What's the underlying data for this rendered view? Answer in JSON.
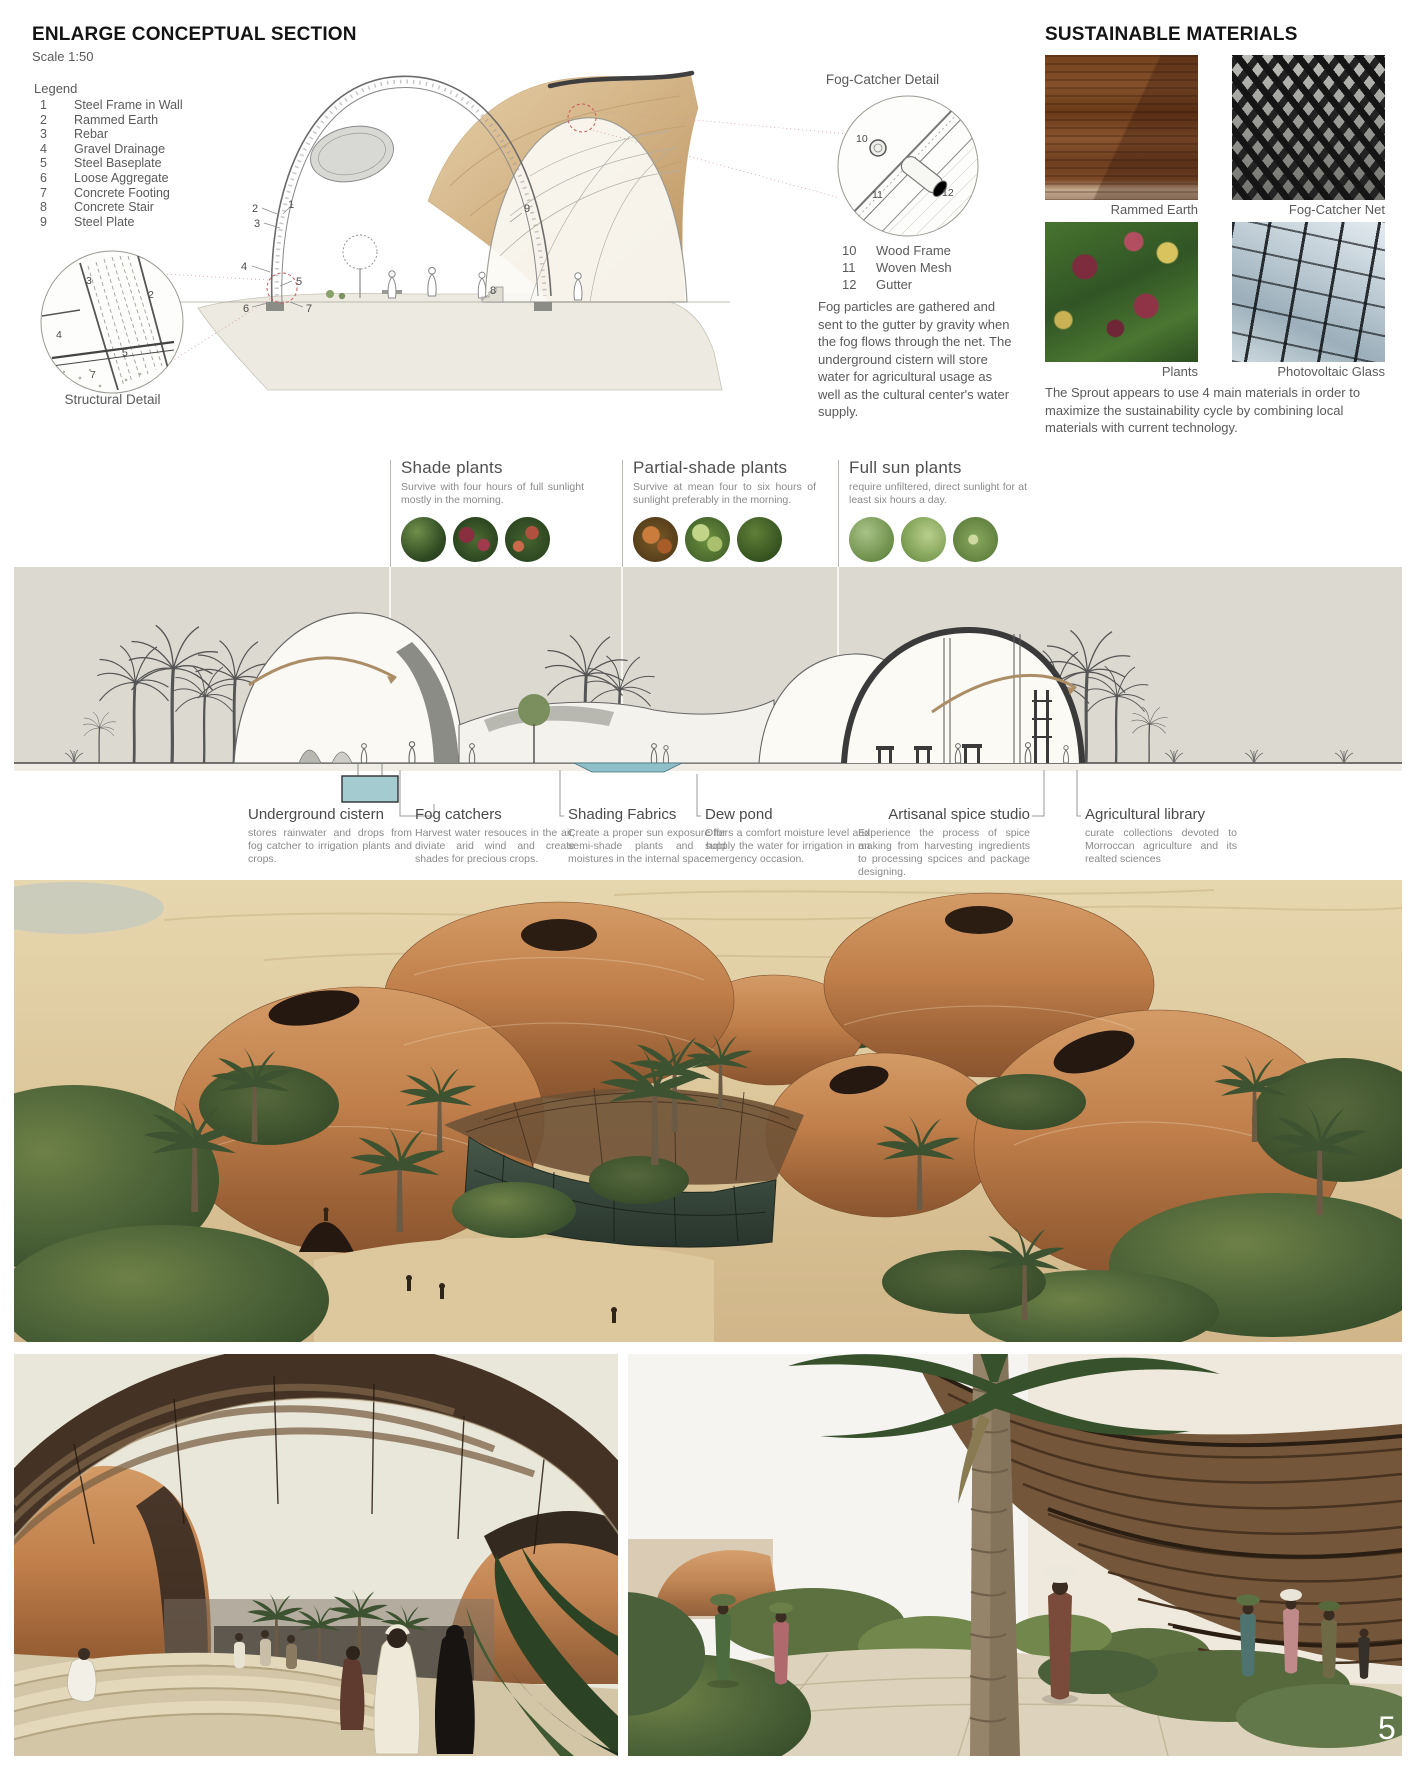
{
  "page": {
    "number": "5"
  },
  "section_panel": {
    "title": "ENLARGE CONCEPTUAL SECTION",
    "scale": "Scale 1:50",
    "legend_title": "Legend",
    "legend": [
      {
        "num": "1",
        "label": "Steel Frame in Wall"
      },
      {
        "num": "2",
        "label": "Rammed Earth"
      },
      {
        "num": "3",
        "label": "Rebar"
      },
      {
        "num": "4",
        "label": "Gravel Drainage"
      },
      {
        "num": "5",
        "label": "Steel Baseplate"
      },
      {
        "num": "6",
        "label": "Loose Aggregate"
      },
      {
        "num": "7",
        "label": "Concrete Footing"
      },
      {
        "num": "8",
        "label": "Concrete Stair"
      },
      {
        "num": "9",
        "label": "Steel Plate"
      }
    ],
    "structural_detail_label": "Structural Detail"
  },
  "fog_detail": {
    "title": "Fog-Catcher Detail",
    "legend": [
      {
        "num": "10",
        "label": "Wood Frame"
      },
      {
        "num": "11",
        "label": "Woven Mesh"
      },
      {
        "num": "12",
        "label": "Gutter"
      }
    ],
    "description": "Fog particles are gathered and sent to the gutter by gravity when the fog flows through the net. The underground cistern will store water for agricultural usage as well as the cultural center's water supply."
  },
  "materials_panel": {
    "title": "SUSTAINABLE MATERIALS",
    "items": [
      {
        "caption": "Rammed Earth"
      },
      {
        "caption": "Fog-Catcher Net"
      },
      {
        "caption": "Plants"
      },
      {
        "caption": "Photovoltaic Glass"
      }
    ],
    "description": "The Sprout appears to use 4 main materials in order to maximize the sustainability cycle by combining local materials with current technology."
  },
  "plant_categories": [
    {
      "title": "Shade plants",
      "description": "Survive with four hours of full sunlight mostly in the morning."
    },
    {
      "title": "Partial-shade plants",
      "description": "Survive at mean four to six hours of sunlight preferably in the morning."
    },
    {
      "title": "Full sun plants",
      "description": "require unfiltered, direct sunlight for at least six hours a day."
    }
  ],
  "features": [
    {
      "title": "Underground cistern",
      "description": "stores rainwater and drops from fog catcher to irrigation plants and crops."
    },
    {
      "title": "Fog catchers",
      "description": "Harvest water resouces in the air, diviate arid wind and create shades for precious crops."
    },
    {
      "title": "Shading Fabrics",
      "description": "Create a proper sun exposure for semi-shade plants and hold moistures in the internal space."
    },
    {
      "title": "Dew pond",
      "description": "Offers a comfort moisture level and supply the water for irrigation in an emergency occasion."
    },
    {
      "title": "Artisanal spice studio",
      "description": "Experience the process of spice making from harvesting ingredients to processing spcices and package designing."
    },
    {
      "title": "Agricultural library",
      "description": "curate collections devoted to Morroccan agriculture and its realted sciences"
    }
  ],
  "annotations": {
    "section": [
      "1",
      "2",
      "3",
      "4",
      "5",
      "6",
      "7",
      "8",
      "9"
    ],
    "structural": [
      "2",
      "3",
      "4",
      "5",
      "7"
    ],
    "fog": [
      "10",
      "11",
      "12"
    ]
  },
  "colors": {
    "elevation_background": "#dcd9d0",
    "water": "#a3cbd0",
    "terracotta": "#b5703f",
    "canopy_brown": "#443324",
    "sand": "#d8c49a"
  }
}
